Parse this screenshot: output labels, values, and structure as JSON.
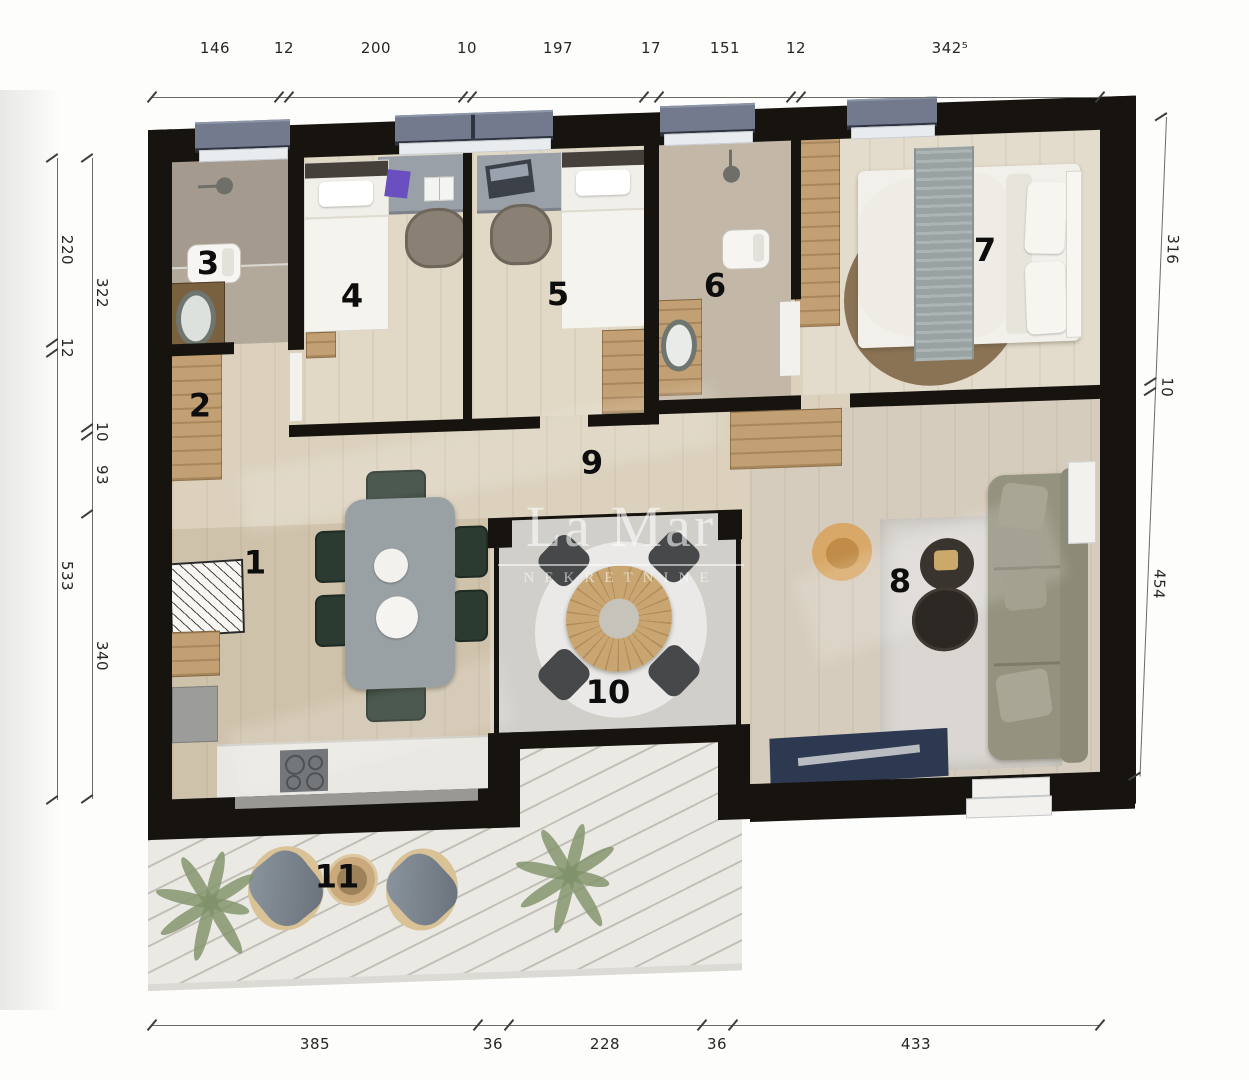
{
  "watermark": {
    "brand": "La Mar",
    "subtitle": "NEKRETNINE"
  },
  "rooms": {
    "labels": [
      "1",
      "2",
      "3",
      "4",
      "5",
      "6",
      "7",
      "8",
      "9",
      "10",
      "11"
    ]
  },
  "dimensions": {
    "top": {
      "labels": [
        "146",
        "12",
        "200",
        "10",
        "197",
        "17",
        "151",
        "12",
        "342⁵"
      ]
    },
    "bottom": {
      "labels": [
        "385",
        "36",
        "228",
        "36",
        "433"
      ]
    },
    "left_outer": {
      "labels": [
        "220",
        "12",
        "533"
      ]
    },
    "left_inner": {
      "labels": [
        "322",
        "10",
        "93",
        "340"
      ]
    },
    "right": {
      "labels": [
        "316",
        "10",
        "454"
      ]
    }
  },
  "colors": {
    "wall": "#17140f",
    "floor": "#dbd1bd",
    "bath_floor": "#a59c8f",
    "wood": "#c2a074",
    "window_frame": "#737a8d",
    "deck": "#ebe9e4",
    "sofa": "#94937f",
    "rug_round": "#8a7254",
    "table_grey": "#9aa1a5",
    "chair_green": "#2c3b31",
    "console_navy": "#2d3950"
  }
}
